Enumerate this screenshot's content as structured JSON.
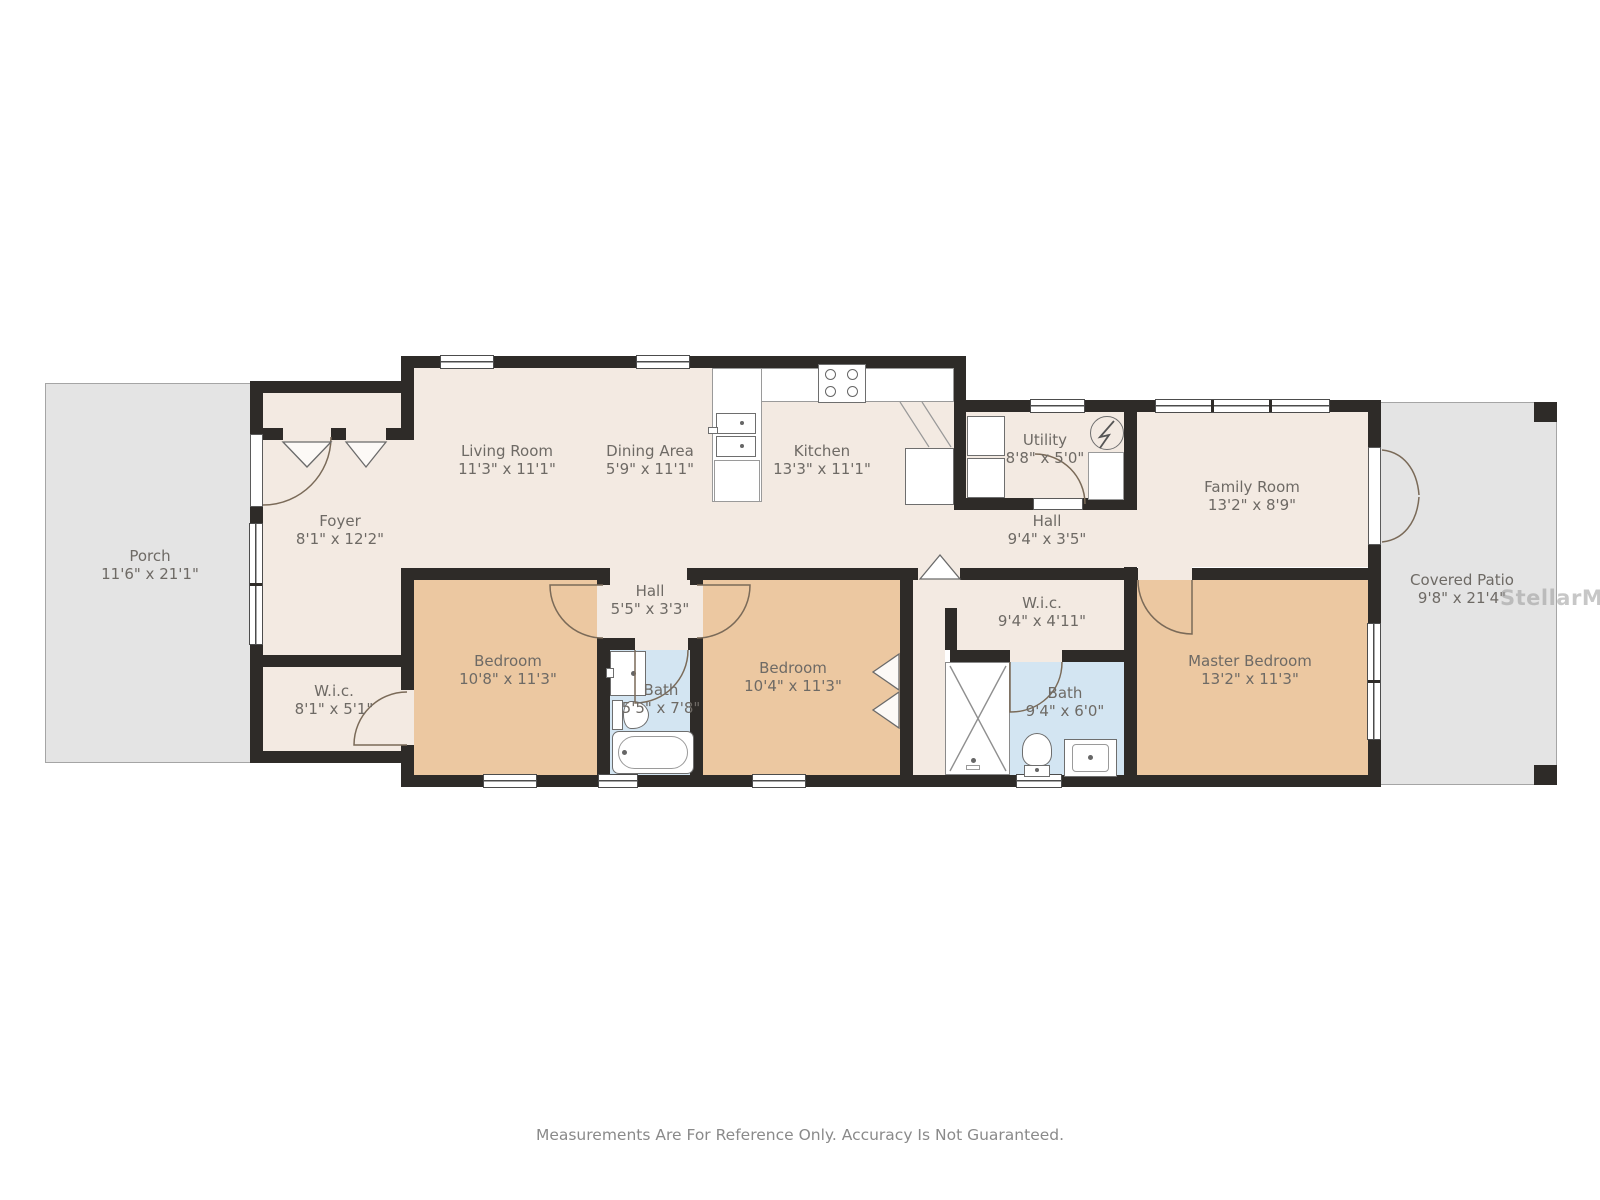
{
  "page": {
    "watermark": "StellarMLS",
    "disclaimer": "Measurements Are For Reference Only. Accuracy Is Not Guaranteed."
  },
  "colors": {
    "wall": "#2e2b28",
    "floor": "#f3eae2",
    "bedroom": "#ecc8a1",
    "bath": "#d3e5f2",
    "outdoor": "#e4e4e4",
    "label": "#6e6a65"
  },
  "rooms": {
    "porch": {
      "name": "Porch",
      "dims": "11'6\" x 21'1\""
    },
    "foyer": {
      "name": "Foyer",
      "dims": "8'1\" x 12'2\""
    },
    "wic_left": {
      "name": "W.i.c.",
      "dims": "8'1\" x 5'1\""
    },
    "living": {
      "name": "Living Room",
      "dims": "11'3\" x 11'1\""
    },
    "dining": {
      "name": "Dining Area",
      "dims": "5'9\" x 11'1\""
    },
    "kitchen": {
      "name": "Kitchen",
      "dims": "13'3\" x 11'1\""
    },
    "utility": {
      "name": "Utility",
      "dims": "8'8\" x 5'0\""
    },
    "hall": {
      "name": "Hall",
      "dims": "9'4\" x 3'5\""
    },
    "family": {
      "name": "Family Room",
      "dims": "13'2\" x 8'9\""
    },
    "patio": {
      "name": "Covered Patio",
      "dims": "9'8\" x 21'4\""
    },
    "bedroom1": {
      "name": "Bedroom",
      "dims": "10'8\" x 11'3\""
    },
    "hall2": {
      "name": "Hall",
      "dims": "5'5\" x 3'3\""
    },
    "bath1": {
      "name": "Bath",
      "dims": "5'5\" x 7'8\""
    },
    "bedroom2": {
      "name": "Bedroom",
      "dims": "10'4\" x 11'3\""
    },
    "wic_master": {
      "name": "W.i.c.",
      "dims": "9'4\" x 4'11\""
    },
    "bath2": {
      "name": "Bath",
      "dims": "9'4\" x 6'0\""
    },
    "master": {
      "name": "Master Bedroom",
      "dims": "13'2\" x 11'3\""
    }
  }
}
